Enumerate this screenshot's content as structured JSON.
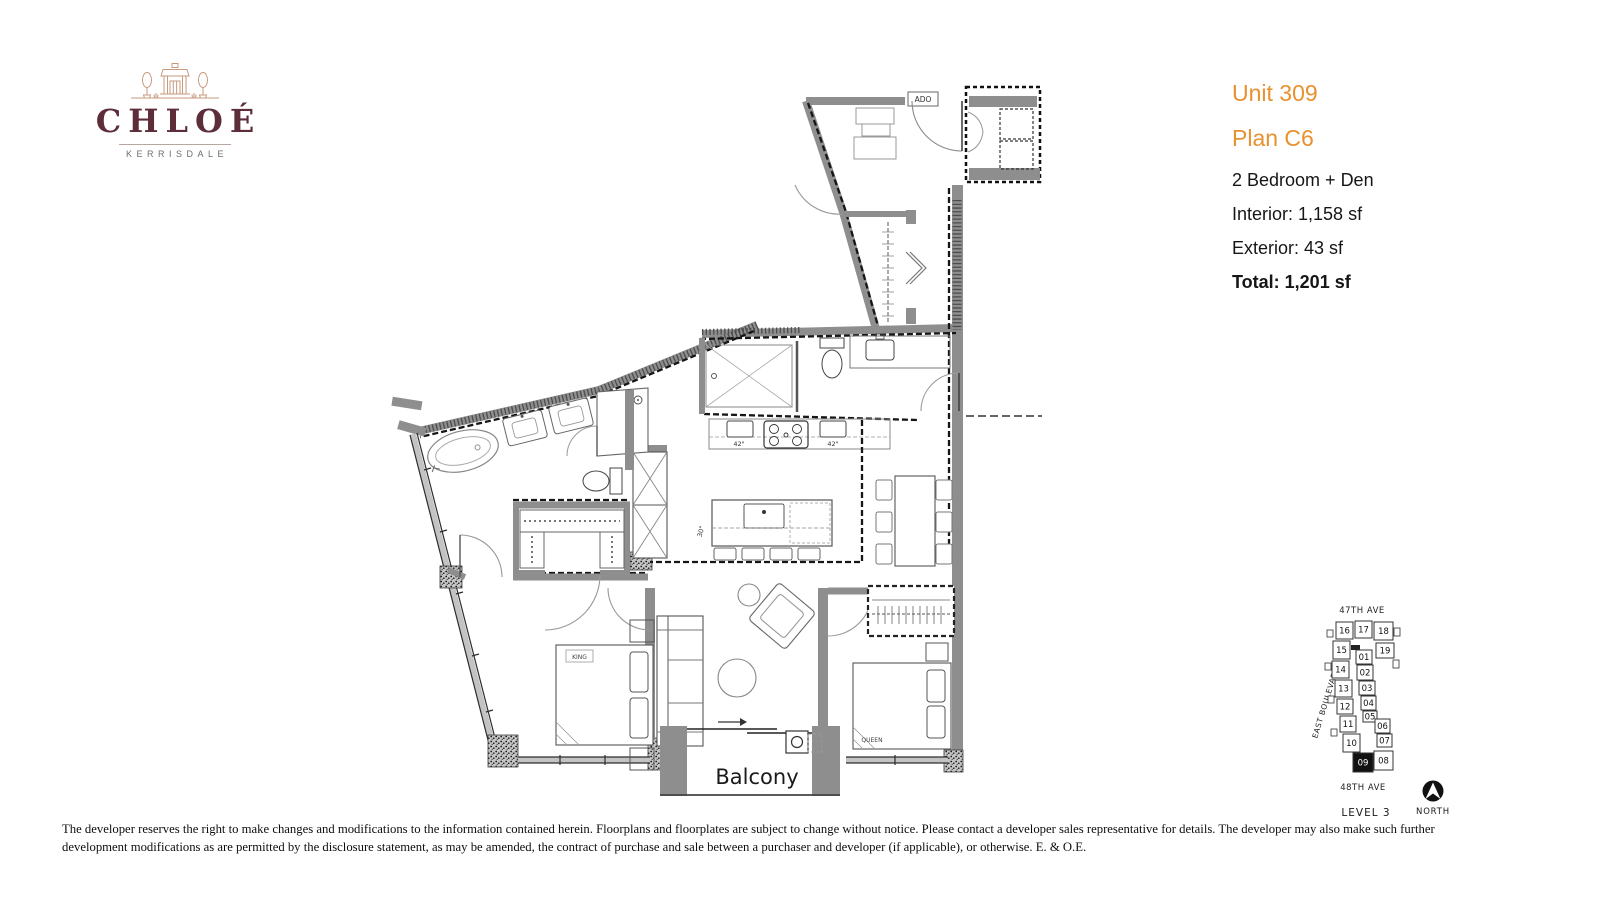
{
  "brand": {
    "name": "CHLOÉ",
    "subtitle": "KERRISDALE"
  },
  "unit_info": {
    "unit": "Unit 309",
    "plan": "Plan C6",
    "bedrooms": "2 Bedroom + Den",
    "interior": "Interior: 1,158 sf",
    "exterior": "Exterior: 43 sf",
    "total": "Total: 1,201 sf"
  },
  "floorplan": {
    "labels": {
      "balcony": "Balcony",
      "king": "KING",
      "queen": "QUEEN",
      "door_tag": "ADO",
      "cab_left": "42\"",
      "cab_right": "42\"",
      "island": "30\""
    }
  },
  "keyplan": {
    "street_top": "47TH AVE",
    "street_bottom": "48TH AVE",
    "street_left": "EAST BOULEVARD",
    "level": "LEVEL 3",
    "north_label": "NORTH",
    "highlighted": "09",
    "units": [
      {
        "label": "16",
        "x": 1336,
        "y": 622,
        "w": 17,
        "h": 17
      },
      {
        "label": "17",
        "x": 1355,
        "y": 621,
        "w": 17,
        "h": 17
      },
      {
        "label": "18",
        "x": 1374,
        "y": 622,
        "w": 19,
        "h": 18
      },
      {
        "label": "15",
        "x": 1333,
        "y": 641,
        "w": 17,
        "h": 18
      },
      {
        "label": "19",
        "x": 1376,
        "y": 643,
        "w": 18,
        "h": 15
      },
      {
        "label": "01",
        "x": 1356,
        "y": 650,
        "w": 16,
        "h": 14
      },
      {
        "label": "14",
        "x": 1332,
        "y": 661,
        "w": 17,
        "h": 17
      },
      {
        "label": "02",
        "x": 1357,
        "y": 665,
        "w": 16,
        "h": 15
      },
      {
        "label": "13",
        "x": 1335,
        "y": 680,
        "w": 17,
        "h": 17
      },
      {
        "label": "03",
        "x": 1359,
        "y": 681,
        "w": 16,
        "h": 14
      },
      {
        "label": "12",
        "x": 1337,
        "y": 699,
        "w": 16,
        "h": 15
      },
      {
        "label": "04",
        "x": 1361,
        "y": 696,
        "w": 15,
        "h": 14
      },
      {
        "label": "05",
        "x": 1363,
        "y": 711,
        "w": 14,
        "h": 11
      },
      {
        "label": "11",
        "x": 1340,
        "y": 716,
        "w": 16,
        "h": 16
      },
      {
        "label": "06",
        "x": 1375,
        "y": 719,
        "w": 15,
        "h": 14
      },
      {
        "label": "10",
        "x": 1343,
        "y": 734,
        "w": 17,
        "h": 18
      },
      {
        "label": "07",
        "x": 1377,
        "y": 734,
        "w": 15,
        "h": 13
      },
      {
        "label": "09",
        "x": 1353,
        "y": 753,
        "w": 20,
        "h": 19,
        "filled": true
      },
      {
        "label": "08",
        "x": 1374,
        "y": 751,
        "w": 19,
        "h": 19
      }
    ]
  },
  "disclaimer": {
    "line1": "The developer reserves the right to make changes and modifications to the information contained herein.  Floorplans and floorplates are subject to change without notice. Please contact a developer sales representative for details. The developer may also make such further",
    "line2": "development modifications as are permitted by the disclosure statement, as may be amended, the contract of purchase and sale between a purchaser and developer (if applicable), or otherwise. E. & O.E."
  },
  "colors": {
    "accent_orange": "#E8912F",
    "logo_burgundy": "#5D2E3A",
    "logo_tan": "#C79A7E",
    "wall_gray": "#8E8E8E"
  }
}
